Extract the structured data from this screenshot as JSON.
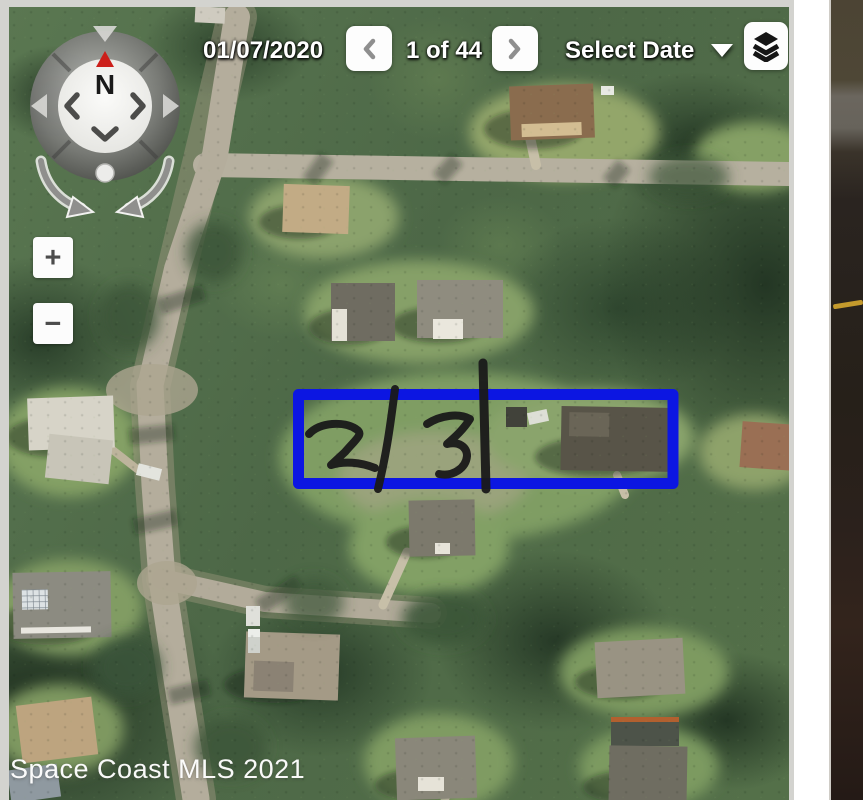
{
  "toolbar": {
    "date": "01/07/2020",
    "position": "1 of 44",
    "select_date_label": "Select Date",
    "prev_icon": "chevron-left",
    "next_icon": "chevron-right",
    "caret_icon": "caret-down",
    "layers_icon": "layers"
  },
  "compass": {
    "north_label": "N",
    "pan_icons": [
      "pan-left",
      "pan-right",
      "pan-down"
    ],
    "rotate_icons": [
      "rotate-counterclockwise",
      "rotate-clockwise"
    ]
  },
  "zoom_controls": {
    "zoom_in_label": "+",
    "zoom_out_label": "−"
  },
  "annotation": {
    "outline_color": "#0c16e2",
    "lot_labels": [
      "2",
      "3"
    ]
  },
  "watermark": {
    "text": "Space Coast MLS 2021"
  }
}
